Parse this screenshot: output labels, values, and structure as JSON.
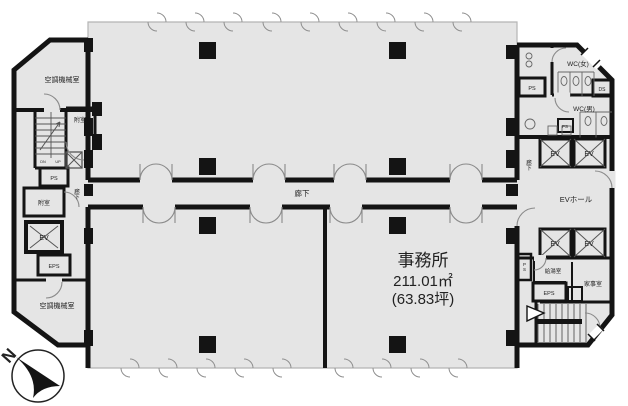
{
  "plan": {
    "office": {
      "name": "事務所",
      "area_m2": "211.01㎡",
      "area_tsubo": "(63.83坪)"
    },
    "corridor": {
      "center": "廊下",
      "left": "廊下",
      "right": "廊下"
    },
    "left_wing": {
      "ac_room_top": "空調機械室",
      "anteroom_top": "附室",
      "ps": "PS",
      "stairs_dn": "DN",
      "stairs_up": "UP",
      "anteroom_bottom": "附室",
      "ev": "EV",
      "eps": "EPS",
      "ac_room_bottom": "空調機械室"
    },
    "right_wing": {
      "wc_women": "WC(女)",
      "ds": "DS",
      "ps_top": "PS",
      "wc_men": "WC(男)",
      "ps_mid": "PS",
      "ev1": "EV",
      "ev2": "EV",
      "ev_hall": "EVホール",
      "ev3": "EV",
      "ev4": "EV",
      "ps_vert": "PS",
      "kyuto": "給湯室",
      "kaji": "家事室",
      "eps": "EPS"
    },
    "compass": {
      "north": "N"
    }
  },
  "colors": {
    "wall": "#141414",
    "floor": "#e5e5e5",
    "floor_border": "#b5b5b5",
    "background": "#ffffff"
  }
}
